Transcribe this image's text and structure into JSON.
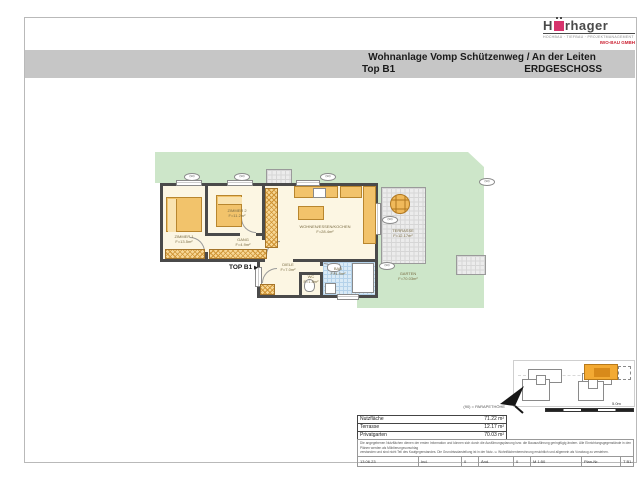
{
  "logo": {
    "brand_prefix": "H",
    "brand_suffix": "rhager",
    "tagline": "HOCHBAU · TIEFBAU · PROJEKTMANAGEMENT",
    "subbrand": "IWO-BAU GMBH"
  },
  "header": {
    "title": "Wohnanlage Vomp Schützenweg / An der Leiten",
    "unit": "Top B1",
    "floor": "ERDGESCHOSS"
  },
  "plan": {
    "entrance_label": "TOP B1",
    "entrance_arrow": "▶",
    "badge_text": "(90)",
    "rooms": {
      "zimmer1": {
        "name": "ZIMMER 1",
        "area": "F=13.5m²"
      },
      "zimmer2": {
        "name": "ZIMMER 2",
        "area": "F=11.2m²"
      },
      "gang": {
        "name": "GANG",
        "area": "F=4.9m²"
      },
      "wohnen": {
        "name": "WOHNEN/ESSEN/KOCHEN",
        "area": "F=28.4m²"
      },
      "diele": {
        "name": "DIELE",
        "area": "F=7.0m²"
      },
      "wc": {
        "name": "WC",
        "area": "F=1.8m²"
      },
      "bad": {
        "name": "BAD",
        "area": "F=4.9m²"
      },
      "terrasse": {
        "name": "TERRASSE",
        "area": "F=12.17m²"
      },
      "garten": {
        "name": "GARTEN",
        "area": "F=70.03m²"
      }
    }
  },
  "legend": "(90) = PARAPETHÖHE",
  "summary": {
    "rows": [
      {
        "label": "Nutzfläche",
        "value": "71.22 m²"
      },
      {
        "label": "Terrasse",
        "value": "12.17 m²"
      },
      {
        "label": "Privatgarten",
        "value": "70.03 m²"
      }
    ]
  },
  "disclaimer": {
    "line1": "Die angegebenen Nutzflächen dienen der ersten Information und können sich durch die Ausführungsplanung bzw. die Bauausführung geringfügig ändern. Alle Einrichtungsgegenstände in den Plänen werden als Möblierungsvorschlag",
    "line2": "verstanden und sind nicht Teil des Kaufgegenstandes. Die Grundrissdarstellung ist in der Nutz- u. Wohnflächenberechnung ersichtlich und allgemein als Vorabzug zu verstehen."
  },
  "titleblock": {
    "date": "13.06.23",
    "ind_label": "Ind.",
    "ind_value": "0",
    "aend_label": "Änd.",
    "aend_value": "0",
    "scale": "M 1:50",
    "plannr_label": "Plan-Nr.",
    "plannr_value": "T B1-0-3"
  },
  "siteplan": {
    "scale_label": "5.0m"
  },
  "colors": {
    "header_band": "#c6c6c6",
    "garden_green": "#cde6c9",
    "wall_gray": "#4a4a4a",
    "room_cream": "#fcf6e3",
    "furniture_orange": "#f2c36b",
    "bath_blue": "#d9eaf6",
    "brand_magenta": "#d6336c",
    "brand_red": "#cc2233"
  }
}
